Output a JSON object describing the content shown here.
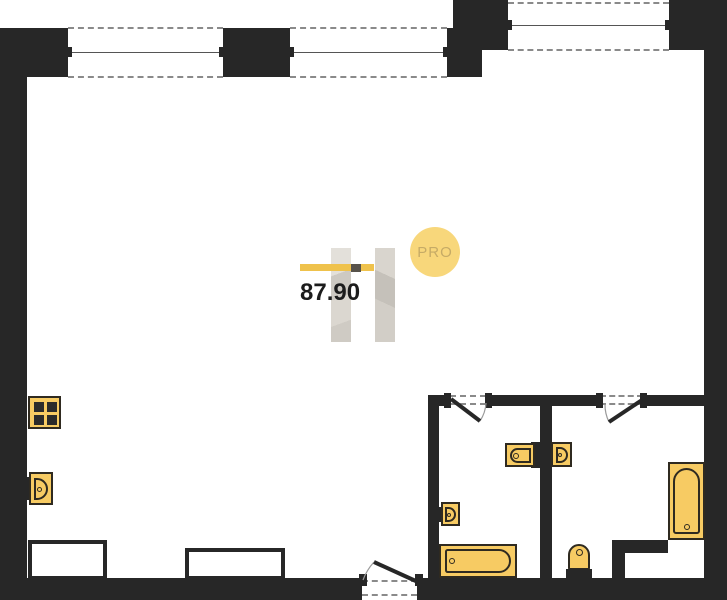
{
  "labels": {
    "area": "87.90",
    "badge": "PRO"
  },
  "colors": {
    "wall": "#272727",
    "window-dash": "#8a8a8a",
    "window-line": "#555555",
    "accent-line": "#EFC24C",
    "fixture-fill": "#F7CB63",
    "fixture-stroke": "#2F2A20",
    "badge-fill": "#F8D77B",
    "badge-text": "#C6AB66",
    "area-text": "#1c1c1c"
  },
  "plan": {
    "type": "apartment-floor-plan",
    "windows": [
      "window-1",
      "window-2",
      "window-3"
    ],
    "doors": [
      "entrance-door",
      "bathroom-1-door",
      "bathroom-2-door"
    ],
    "fixtures": [
      "stove",
      "kitchen-sink",
      "bathroom-1-washbasin",
      "bathroom-1-bathtub",
      "double-washbasin-left",
      "double-washbasin-right",
      "bathroom-2-bathtub",
      "toilet"
    ],
    "furniture": [
      "counter-1",
      "counter-2"
    ]
  }
}
